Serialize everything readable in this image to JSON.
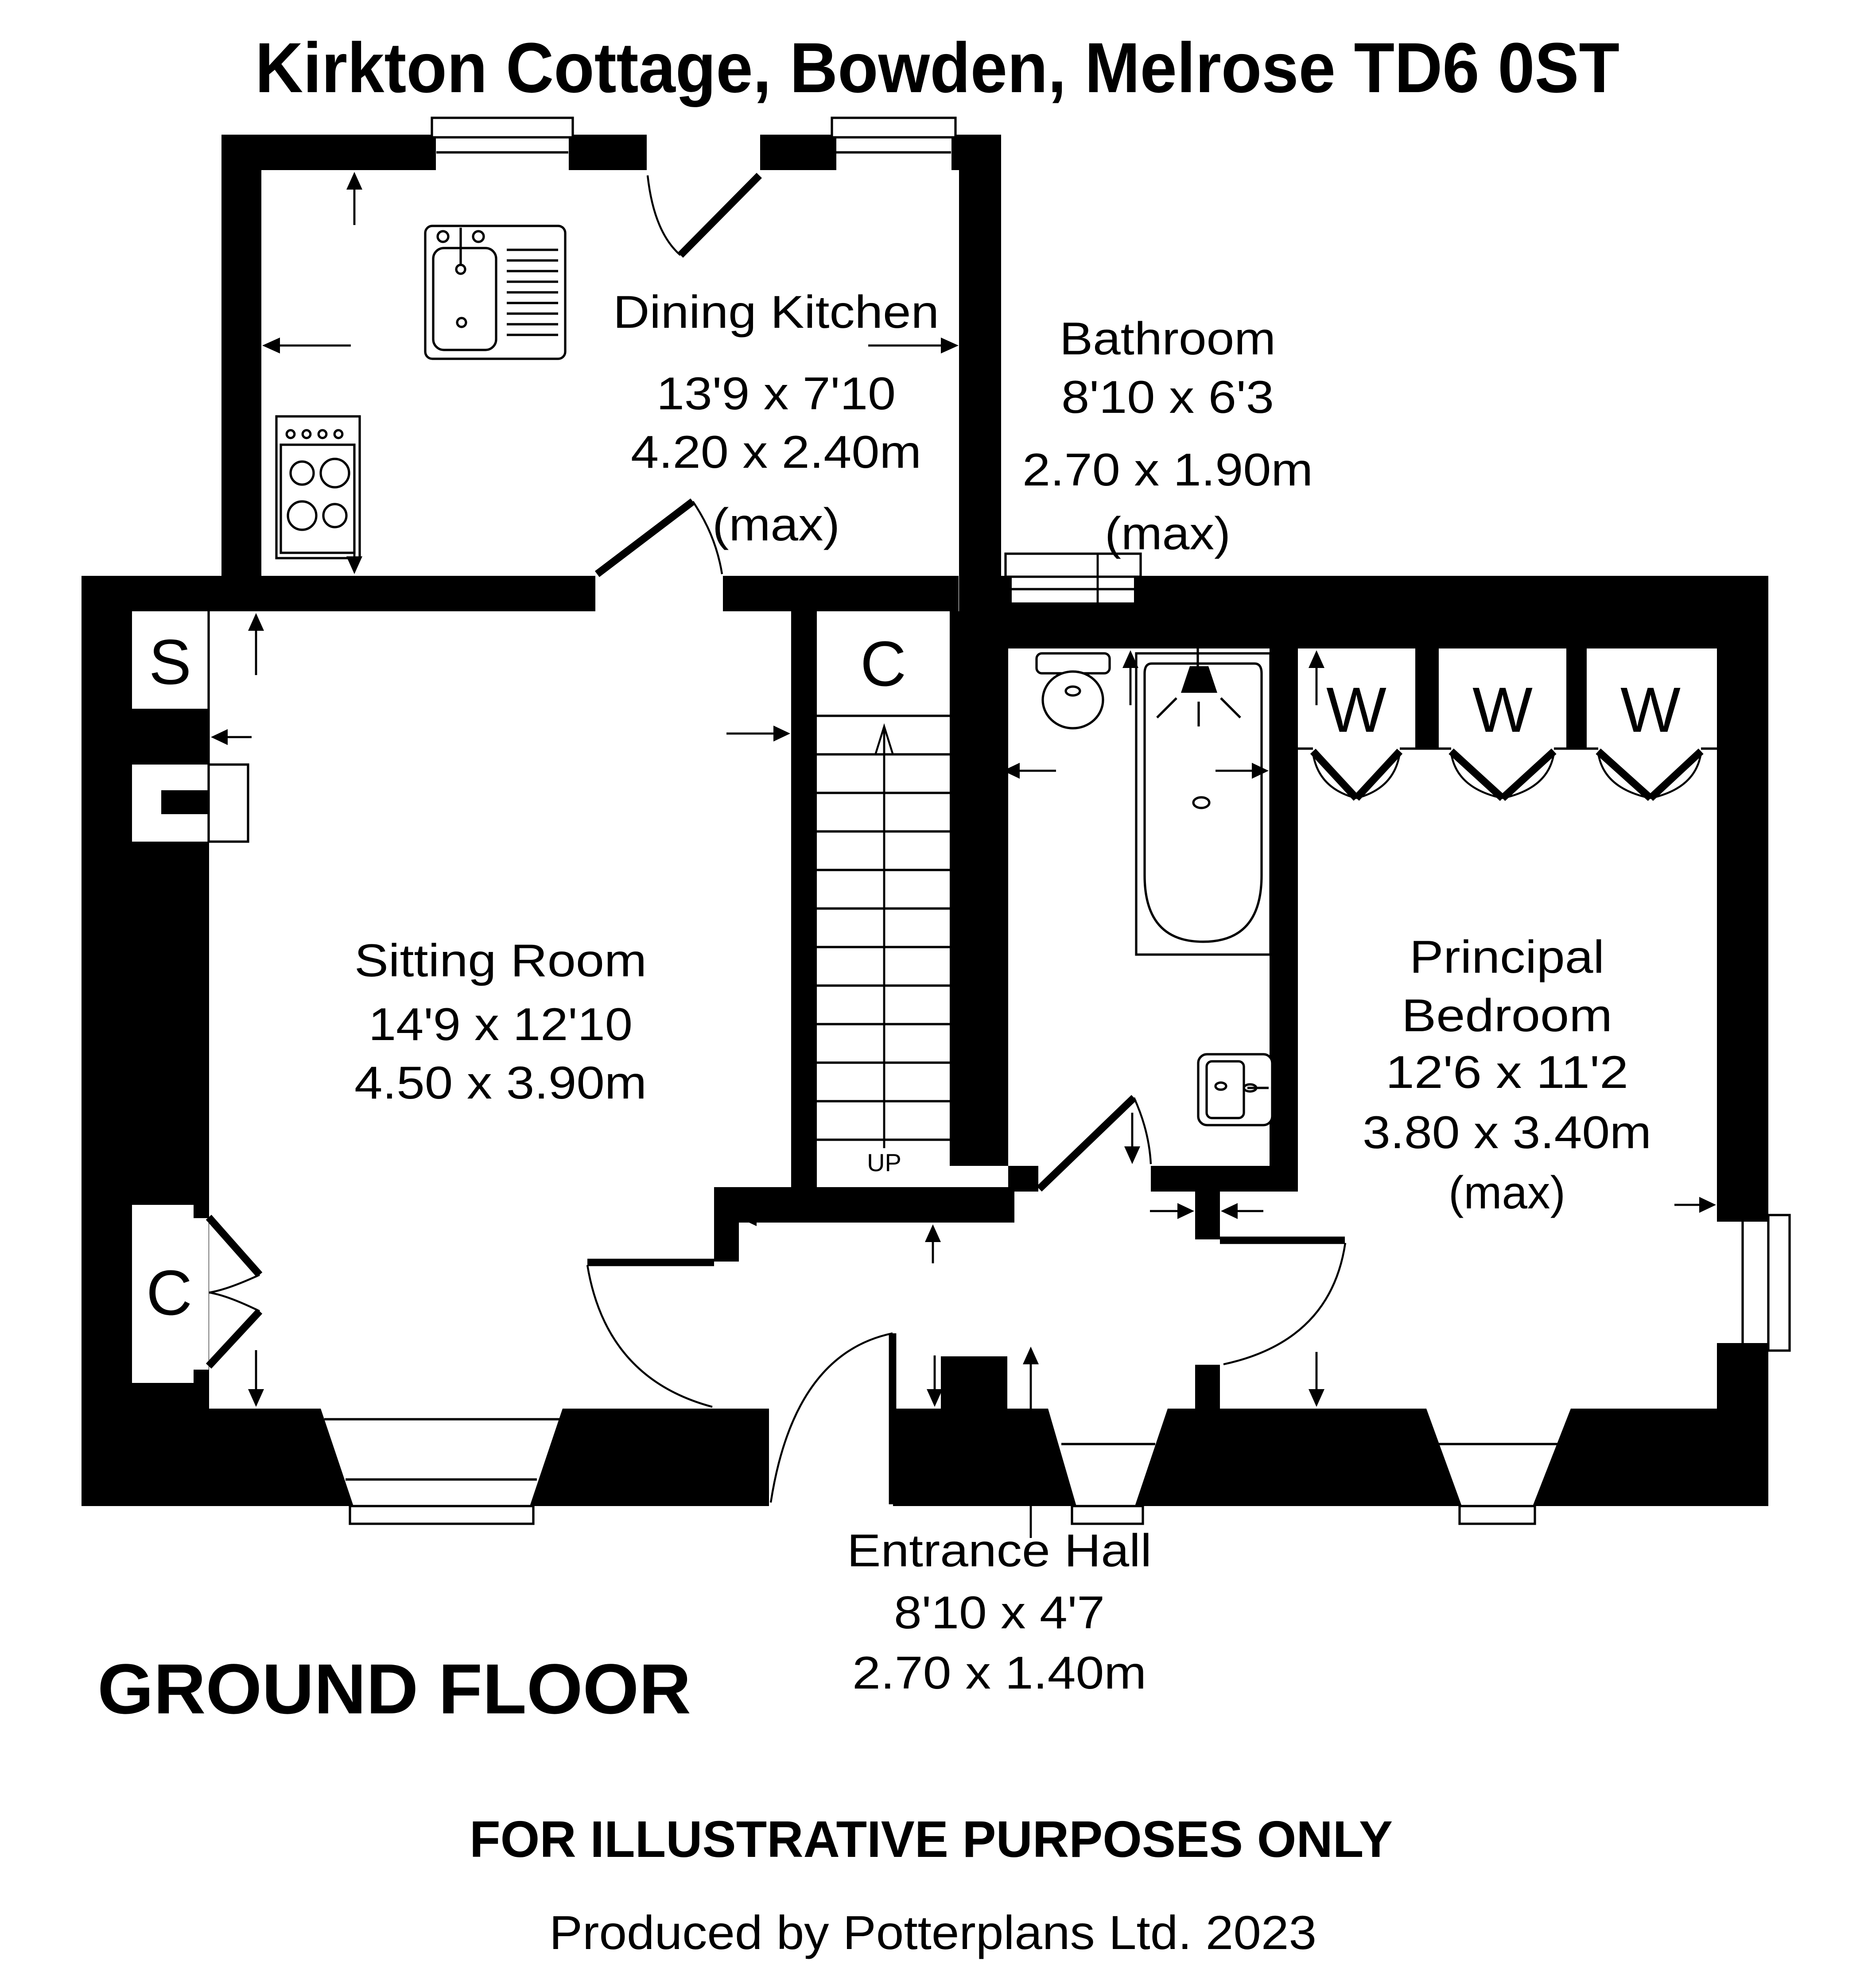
{
  "title": "Kirkton Cottage, Bowden, Melrose TD6 0ST",
  "floor_label": "GROUND FLOOR",
  "footer": {
    "disclaimer": "FOR ILLUSTRATIVE PURPOSES ONLY",
    "credit": "Produced by Potterplans Ltd. 2023"
  },
  "rooms": {
    "dining_kitchen": {
      "name": "Dining Kitchen",
      "imperial": "13'9 x 7'10",
      "metric": "4.20 x 2.40m",
      "qualifier": "(max)"
    },
    "bathroom": {
      "name": "Bathroom",
      "imperial": "8'10 x 6'3",
      "metric": "2.70 x 1.90m",
      "qualifier": "(max)"
    },
    "sitting_room": {
      "name": "Sitting Room",
      "imperial": "14'9 x 12'10",
      "metric": "4.50 x 3.90m"
    },
    "principal_bedroom": {
      "name_line1": "Principal",
      "name_line2": "Bedroom",
      "imperial": "12'6 x 11'2",
      "metric": "3.80 x 3.40m",
      "qualifier": "(max)"
    },
    "entrance_hall": {
      "name": "Entrance Hall",
      "imperial": "8'10 x 4'7",
      "metric": "2.70 x 1.40m"
    }
  },
  "labels": {
    "up": "UP",
    "closet": "C",
    "store": "S",
    "wardrobe": "W"
  },
  "colors": {
    "walls": "#000000",
    "background": "#ffffff"
  }
}
